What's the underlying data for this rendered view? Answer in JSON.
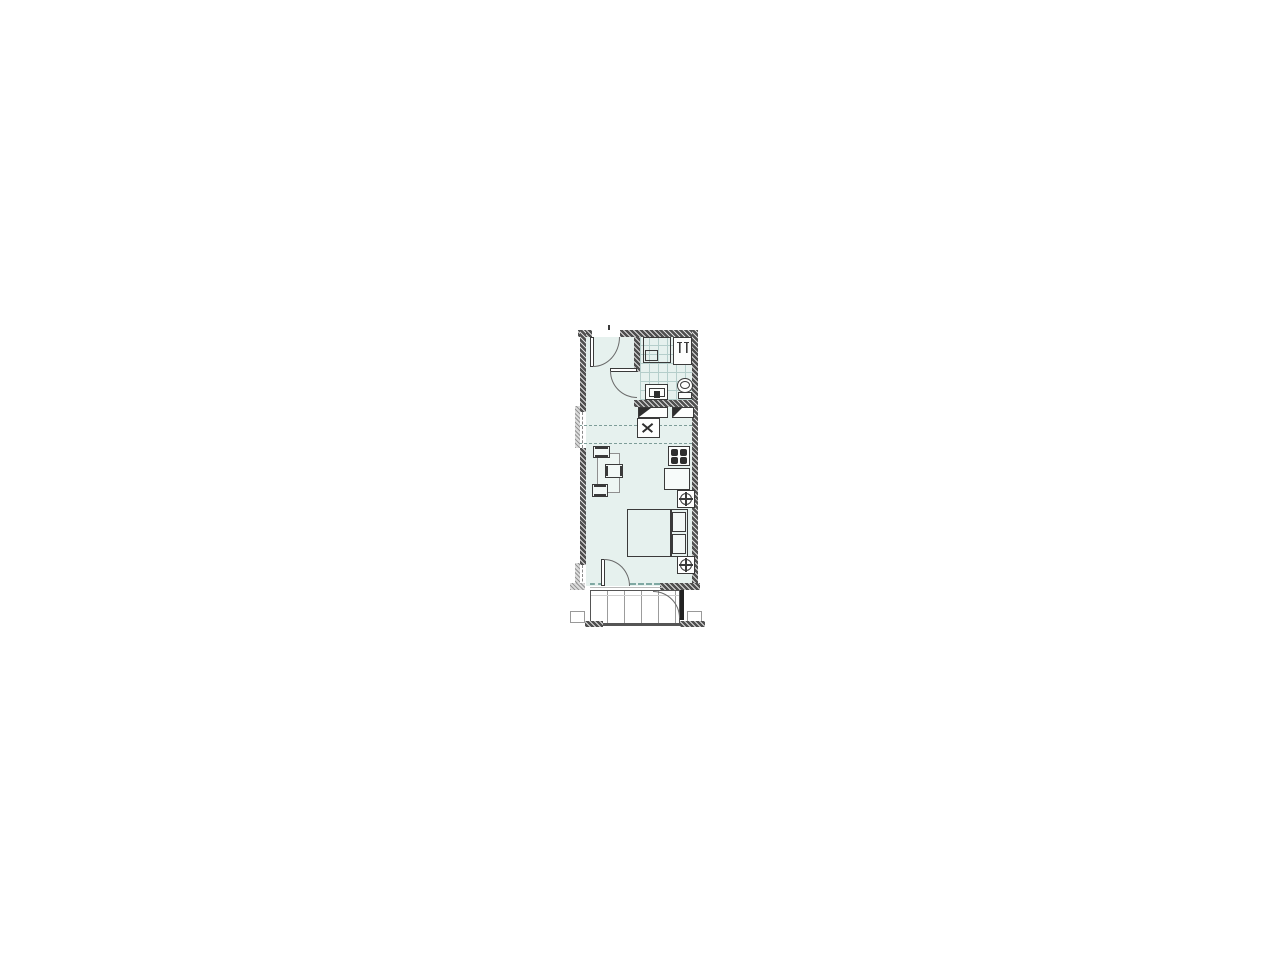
{
  "document": {
    "type": "architectural floor plan",
    "description": "Studio apartment unit: entry hall, tiled bathroom, kitchenette strip, combined living and sleeping room, balcony below",
    "visible_text_on_drawing": ""
  },
  "colors": {
    "floor": "#e6f1ee",
    "wall": "#4f4f4f",
    "line": "#3a3a3a",
    "arc": "#6a6a6a",
    "tile_line": "#b5cecb",
    "glazing_dash": "#7fa8a2",
    "ceiling_dash": "#7d9d98",
    "furniture_light": "#8f8f8f",
    "burner": "#2e2e2e",
    "balcony_line": "#9c9c9c"
  },
  "rooms": [
    {
      "id": "entry-hall",
      "label": "Entry hall"
    },
    {
      "id": "bathroom",
      "label": "Bathroom"
    },
    {
      "id": "kitchen",
      "label": "Kitchenette"
    },
    {
      "id": "living-room",
      "label": "Living / sleeping room"
    },
    {
      "id": "balcony",
      "label": "Balcony"
    }
  ],
  "fixtures": [
    {
      "id": "entry-door",
      "label": "Entry door with swing arc"
    },
    {
      "id": "bathroom-door",
      "label": "Bathroom door with swing arc"
    },
    {
      "id": "shower",
      "label": "Shower tray"
    },
    {
      "id": "washing-machine",
      "label": "Washing machine / hook-ups"
    },
    {
      "id": "bathroom-sink",
      "label": "Washbasin vanity"
    },
    {
      "id": "toilet",
      "label": "Toilet"
    },
    {
      "id": "kitchen-cabinets",
      "label": "Kitchen base cabinets"
    },
    {
      "id": "kitchen-sink",
      "label": "Kitchen sink with faucet symbol"
    },
    {
      "id": "stove",
      "label": "Four-burner cooktop"
    },
    {
      "id": "tall-cabinet",
      "label": "Tall cabinet / fridge"
    },
    {
      "id": "dining-table",
      "label": "Dining table"
    },
    {
      "id": "chairs",
      "label": "Three chairs"
    },
    {
      "id": "bed",
      "label": "Double bed with two pillows"
    },
    {
      "id": "service-symbols",
      "label": "Two circled-cross service symbols at right wall"
    },
    {
      "id": "balcony-door",
      "label": "Balcony door with swing arc"
    },
    {
      "id": "balcony-partition-door",
      "label": "Balcony partition door with swing arc"
    }
  ]
}
